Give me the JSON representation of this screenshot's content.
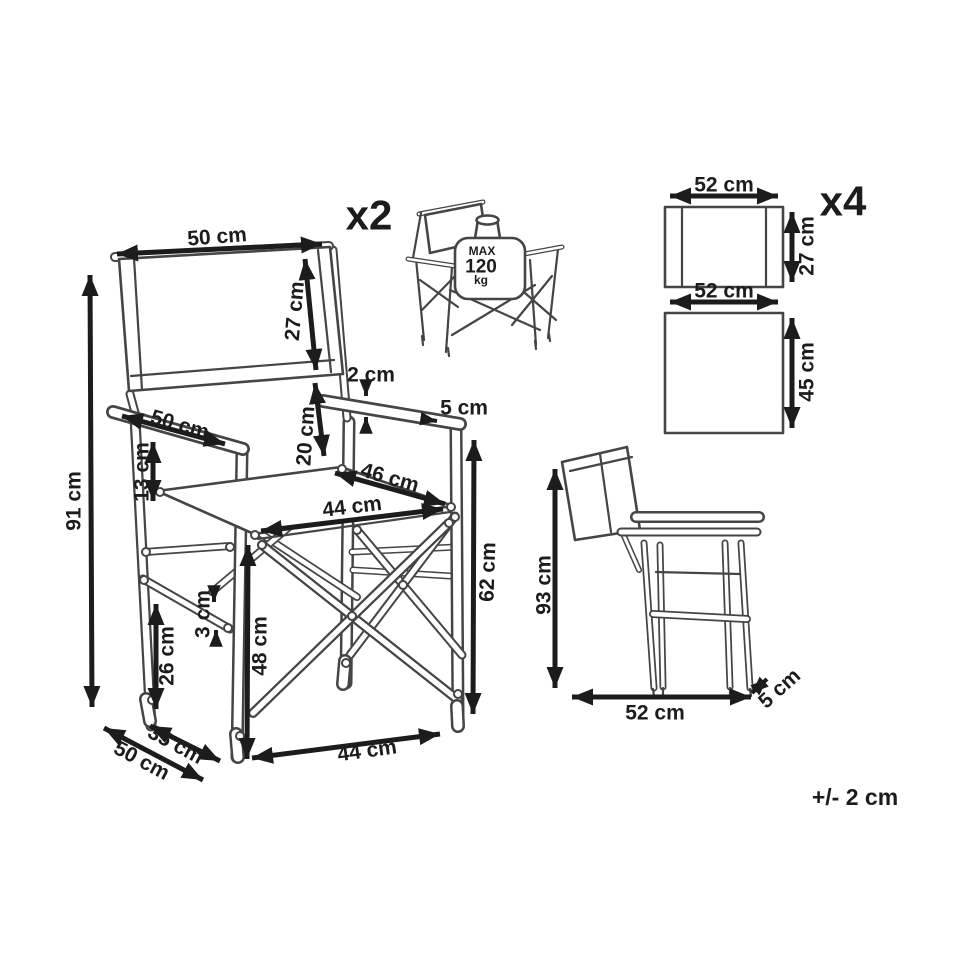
{
  "colors": {
    "line": "#454547",
    "ink": "#1c1c1e",
    "background": "#ffffff"
  },
  "tolerance_note": "+/- 2 cm",
  "main_chair": {
    "quantity_label": "x2",
    "max_load": {
      "line1": "MAX",
      "line2": "120",
      "line3": "kg"
    },
    "dimensions": {
      "back_width": "50 cm",
      "back_height": "27 cm",
      "total_height": "91 cm",
      "armrest_length": "50 cm",
      "armrest_to_seat": "13 cm",
      "armrest_thickness": "2 cm",
      "back_to_seat": "20 cm",
      "armrest_width": "5 cm",
      "seat_depth": "46 cm",
      "seat_width": "44 cm",
      "armrest_height": "62 cm",
      "seat_height": "48 cm",
      "stretcher_thickness": "3 cm",
      "stretcher_height": "26 cm",
      "leg_spread_depth": "35 cm",
      "base_depth": "50 cm",
      "base_width": "44 cm"
    }
  },
  "fabric_pieces": {
    "quantity_label": "x4",
    "back_panel": {
      "width": "52 cm",
      "height": "27 cm"
    },
    "seat_panel": {
      "width": "52 cm",
      "height": "45 cm"
    }
  },
  "folded_chair": {
    "height": "93 cm",
    "width": "52 cm",
    "depth": "5 cm"
  }
}
